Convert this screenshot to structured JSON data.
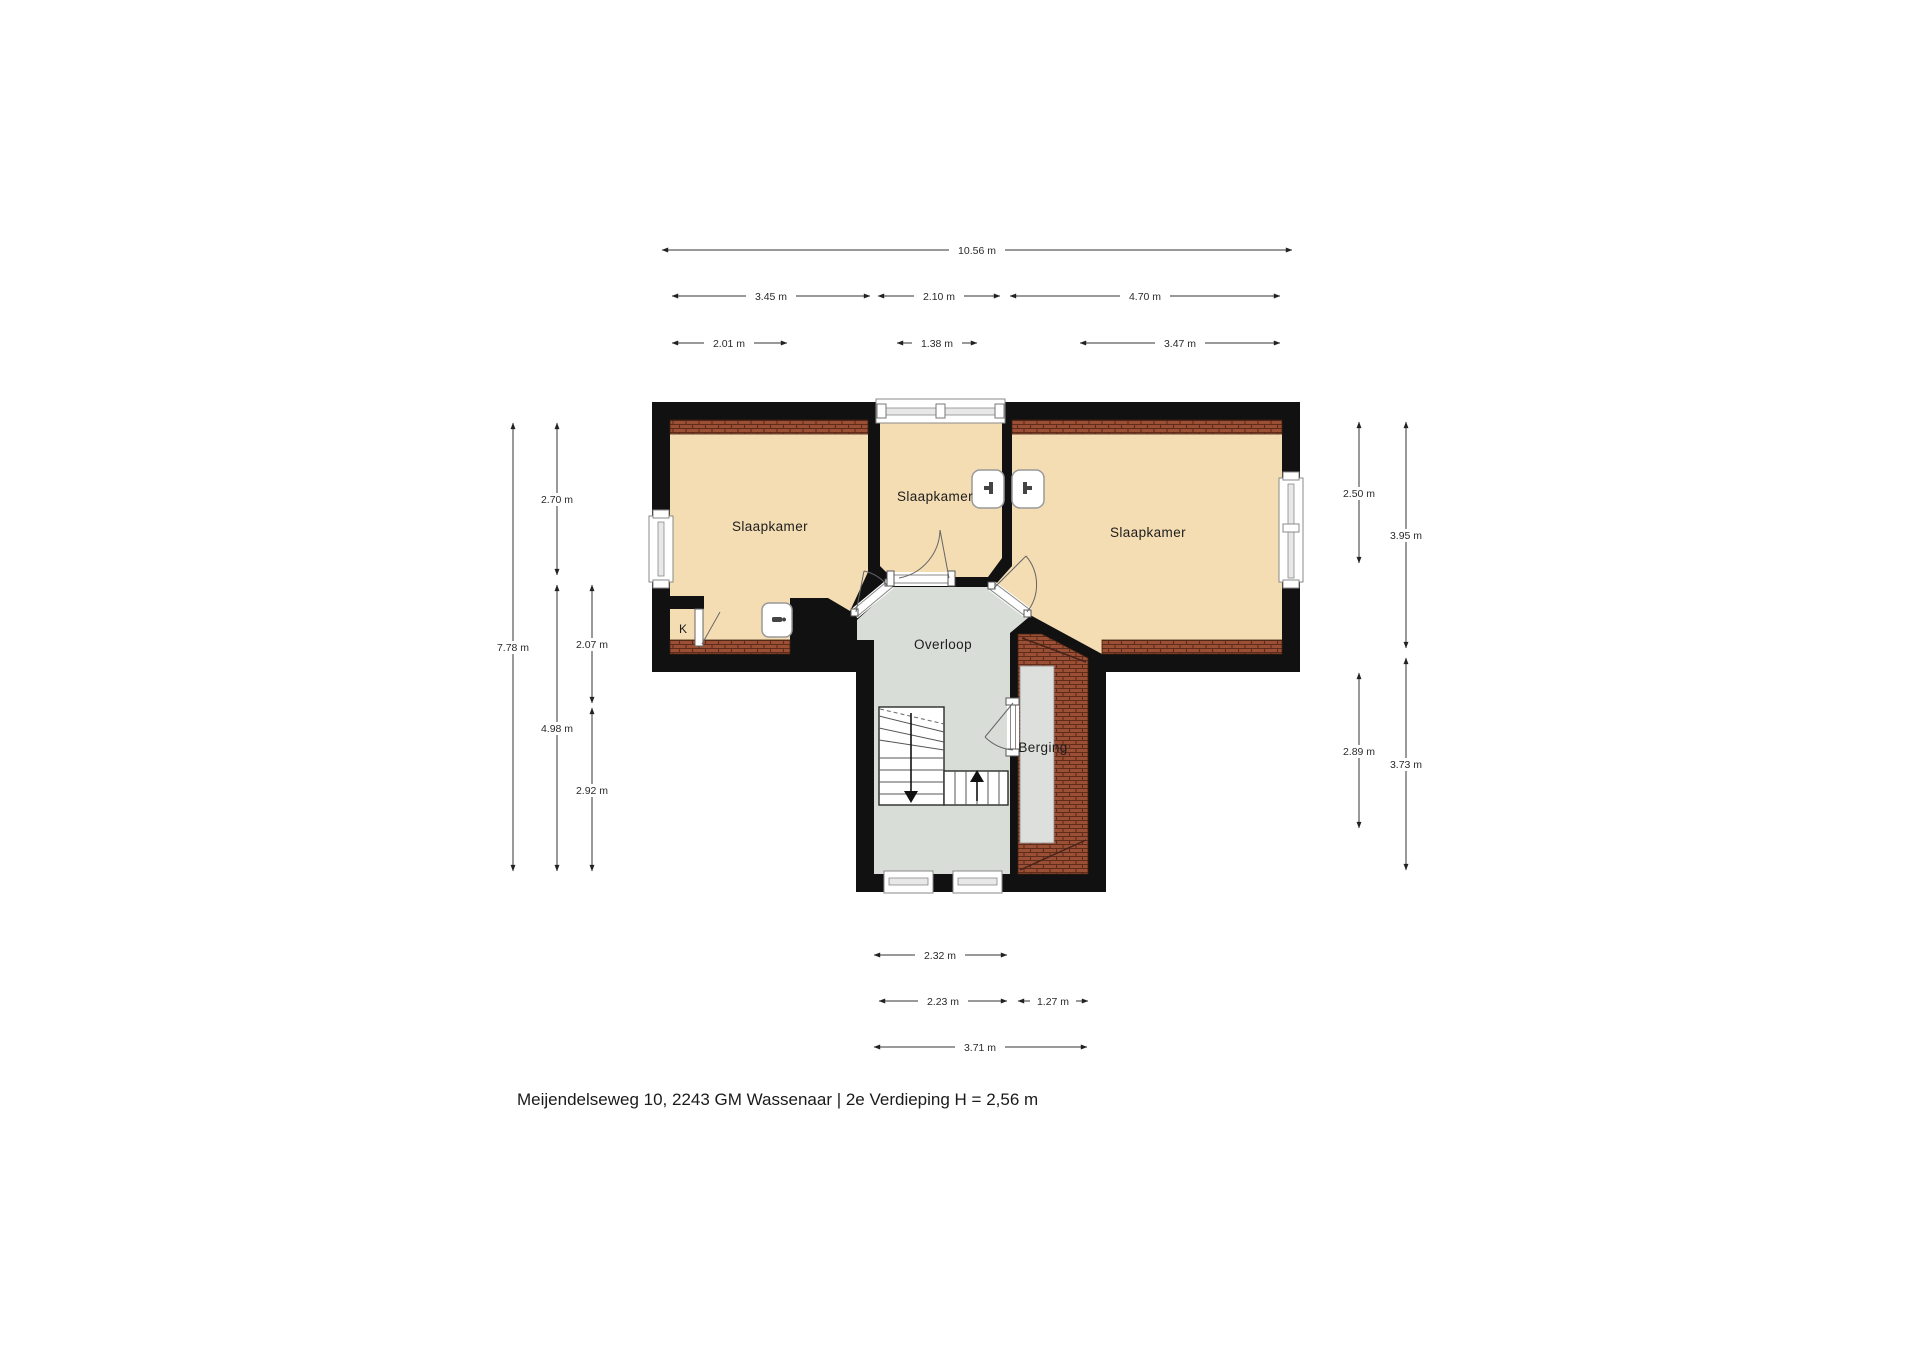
{
  "rooms": {
    "bedroom_left": {
      "label": "Slaapkamer"
    },
    "bedroom_middle": {
      "label": "Slaapkamer"
    },
    "bedroom_right": {
      "label": "Slaapkamer"
    },
    "landing": {
      "label": "Overloop"
    },
    "storage": {
      "label": "Berging"
    },
    "closet": {
      "label": "K"
    }
  },
  "dims": {
    "t1": {
      "label": "10.56 m"
    },
    "t2a": {
      "label": "3.45 m"
    },
    "t2b": {
      "label": "2.10 m"
    },
    "t2c": {
      "label": "4.70 m"
    },
    "t3a": {
      "label": "2.01 m"
    },
    "t3b": {
      "label": "1.38 m"
    },
    "t3c": {
      "label": "3.47 m"
    },
    "l1": {
      "label": "7.78 m"
    },
    "l2a": {
      "label": "2.70 m"
    },
    "l2b": {
      "label": "4.98 m"
    },
    "l3a": {
      "label": "2.07 m"
    },
    "l3b": {
      "label": "2.92 m"
    },
    "r1a": {
      "label": "2.50 m"
    },
    "r1b": {
      "label": "2.89 m"
    },
    "r2a": {
      "label": "3.95 m"
    },
    "r2b": {
      "label": "3.73 m"
    },
    "b1": {
      "label": "2.32 m"
    },
    "b2a": {
      "label": "2.23 m"
    },
    "b2b": {
      "label": "1.27 m"
    },
    "b3": {
      "label": "3.71 m"
    }
  },
  "caption": "Meijendelseweg 10, 2243 GM Wassenaar | 2e Verdieping H = 2,56 m",
  "colors": {
    "wall": "#111111",
    "room_floor": "#f4ddb3",
    "hall_floor": "#d9ddd8",
    "roof_tiles": "#9b5036",
    "roof_tile_joint": "#5f2c1c",
    "dim_line": "#333333"
  }
}
